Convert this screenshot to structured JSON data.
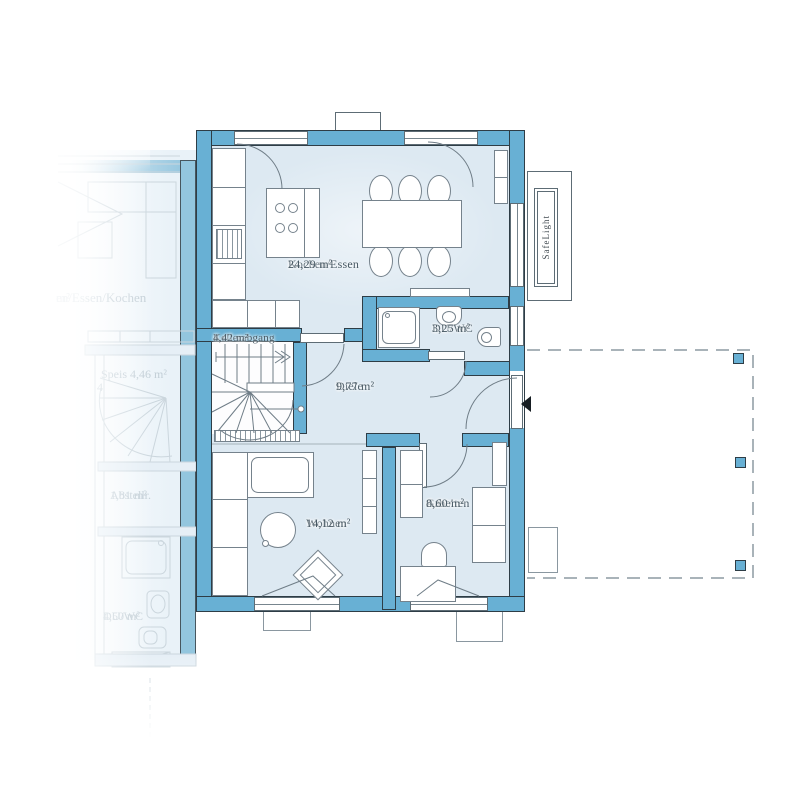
{
  "floorplan": {
    "rooms": [
      {
        "name": "Kochen/Essen",
        "area": "24,29 m²"
      },
      {
        "name": "DU/WC",
        "area": "3,25 m²"
      },
      {
        "name": "Kellerabgang",
        "area": "4,42 m²"
      },
      {
        "name": "Diele",
        "area": "9,77 m²"
      },
      {
        "name": "Wohnen",
        "area": "14,12 m²"
      },
      {
        "name_line1": "Gast/",
        "name_line2": "Arbeiten",
        "area": "8,60 m²"
      }
    ],
    "neighbor": {
      "truncated_room": "en/Essen/Kochen",
      "truncated_area": "m²",
      "speis": "Speis 4,46 m²",
      "stair_number": "4",
      "abstell_name": "Abstellr.",
      "abstell_area": "1,81 m²",
      "duwc_name": "DU/WC",
      "duwc_area": "4,50 m²"
    },
    "annotations": {
      "safelight": "SafeLight"
    },
    "colors": {
      "wall_blue": "#68b0d4",
      "room_fill": "#dde9f2",
      "outline_dark": "#2e3d46",
      "faded_stroke": "#cbd6dd",
      "terrace_dash": "#a9b3b9",
      "label_text": "#485964"
    }
  }
}
